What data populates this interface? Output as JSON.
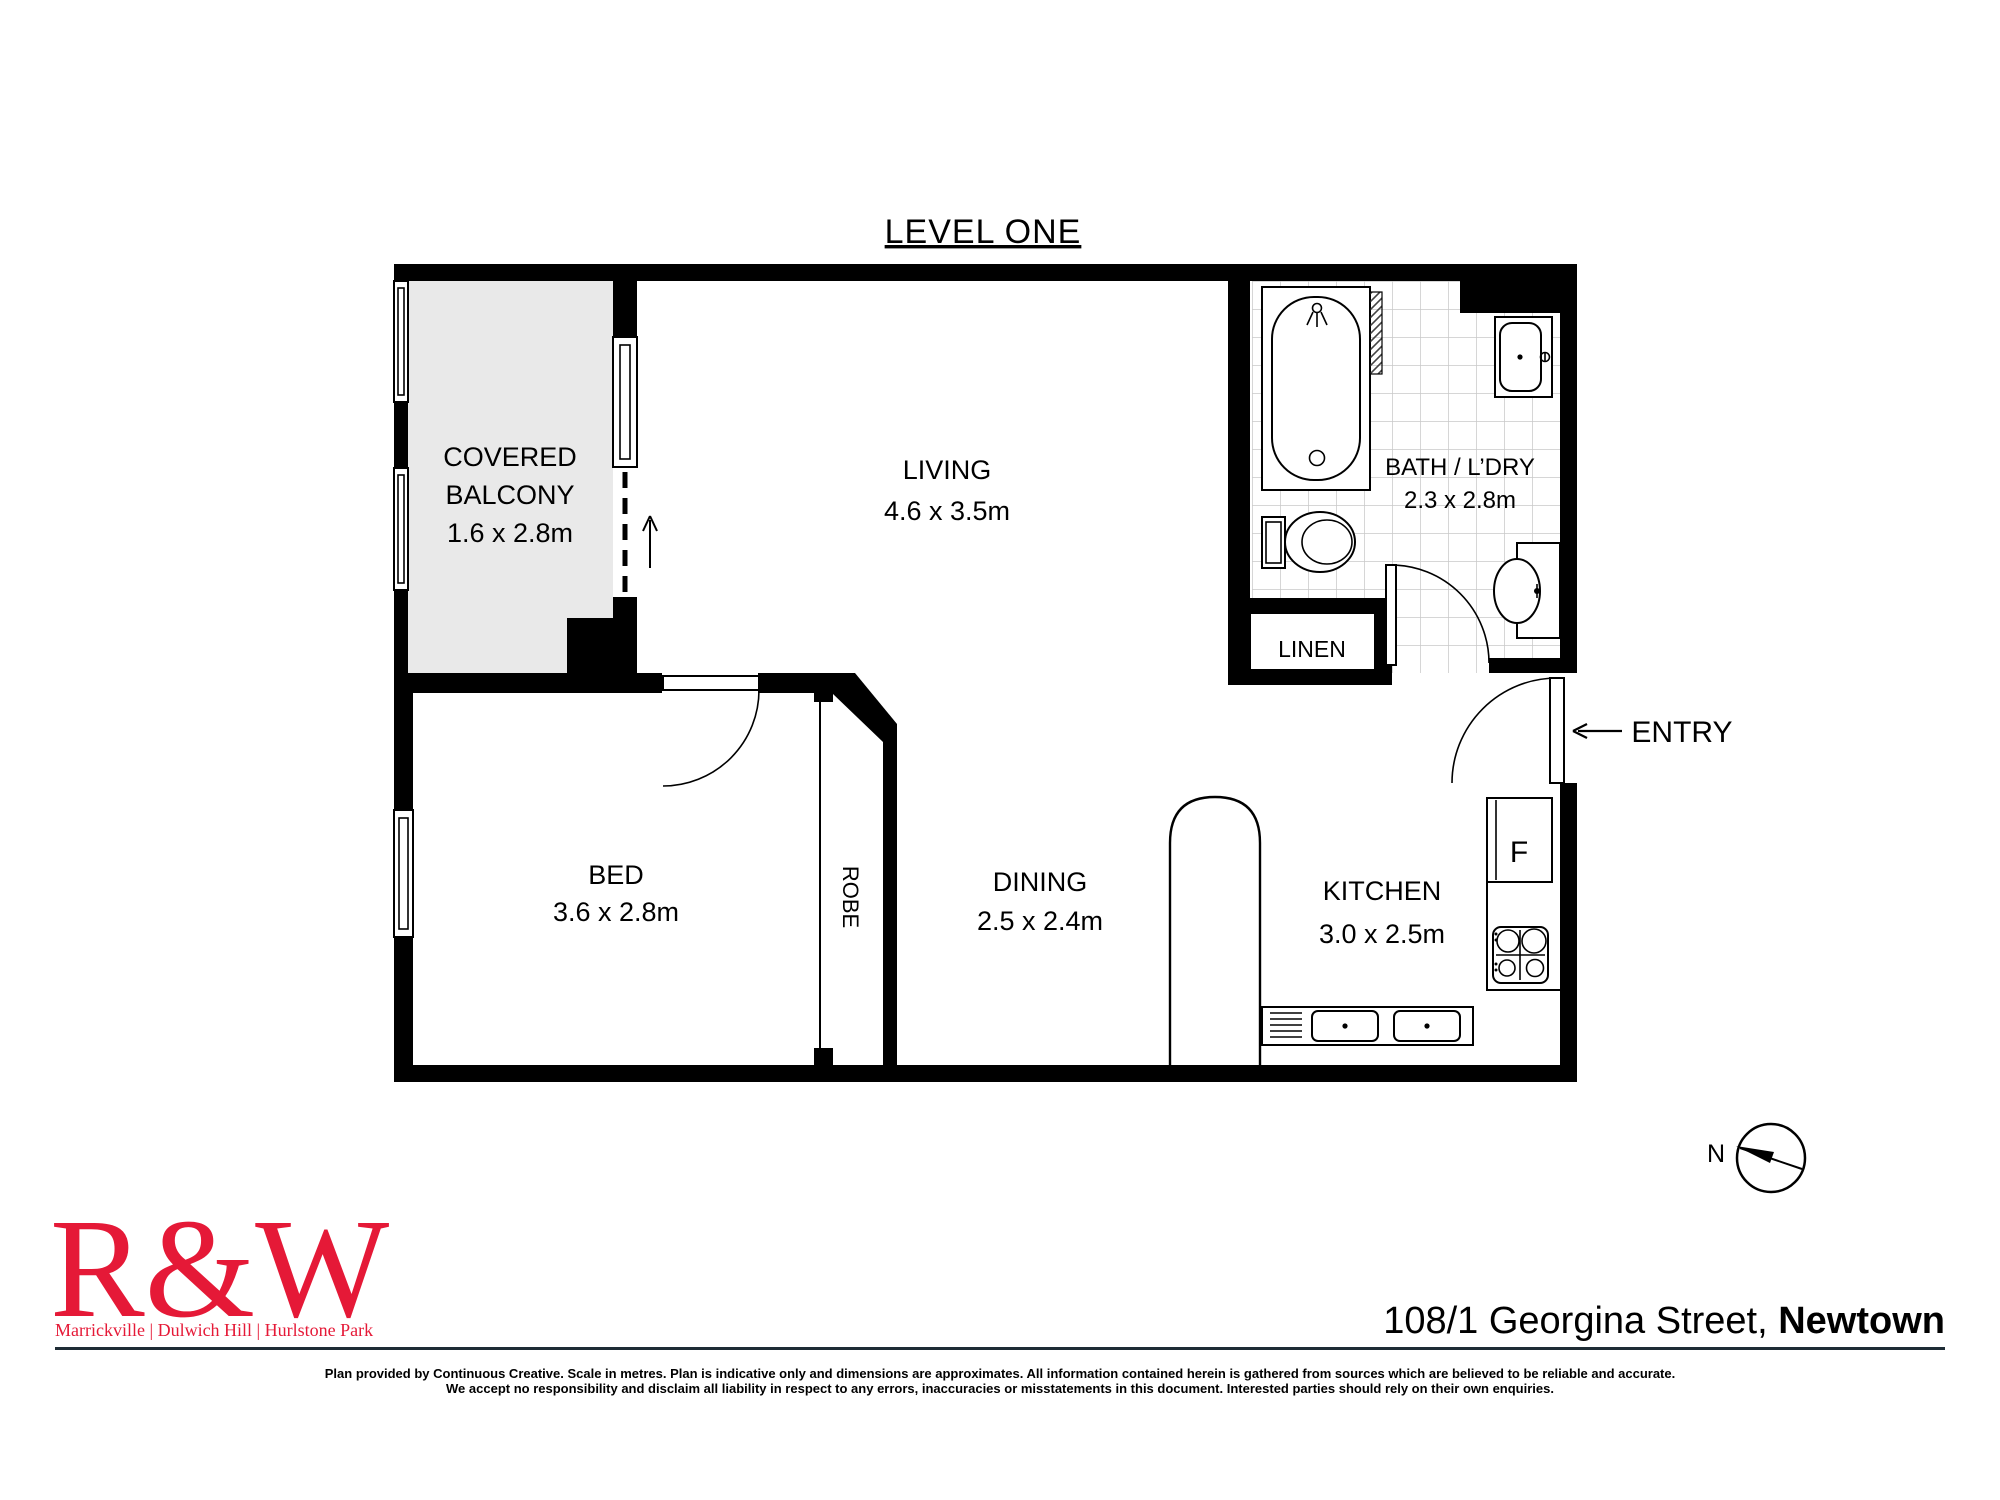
{
  "title": "LEVEL ONE",
  "rooms": {
    "balcony": {
      "line1": "COVERED",
      "line2": "BALCONY",
      "dims": "1.6 x 2.8m"
    },
    "living": {
      "name": "LIVING",
      "dims": "4.6 x 3.5m"
    },
    "bath": {
      "name": "BATH / L’DRY",
      "dims": "2.3 x 2.8m"
    },
    "linen": {
      "name": "LINEN"
    },
    "entry": {
      "name": "ENTRY"
    },
    "bed": {
      "name": "BED",
      "dims": "3.6 x 2.8m"
    },
    "robe": {
      "name": "ROBE"
    },
    "dining": {
      "name": "DINING",
      "dims": "2.5 x 2.4m"
    },
    "kitchen": {
      "name": "KITCHEN",
      "dims": "3.0 x 2.5m"
    },
    "fridge_label": "F"
  },
  "compass": {
    "north_label": "N"
  },
  "footer": {
    "logo_text": "R&W",
    "offices": "Marrickville | Dulwich Hill | Hurlstone Park",
    "address_regular": "108/1 Georgina Street, ",
    "address_bold": "Newtown",
    "disclaimer_line1": "Plan provided by Continuous Creative. Scale in metres. Plan is indicative only and dimensions are approximates. All information contained herein is gathered from sources which are believed to be reliable and accurate.",
    "disclaimer_line2": "We accept no responsibility and disclaim all liability in respect to any errors, inaccuracies or misstatements in this document. Interested parties should rely on their own enquiries."
  },
  "colors": {
    "wall": "#000000",
    "balcony_fill": "#e9e9e9",
    "tile_line": "#c9c9c9",
    "brand_red": "#e51937",
    "text_dark": "#1e2c35"
  }
}
